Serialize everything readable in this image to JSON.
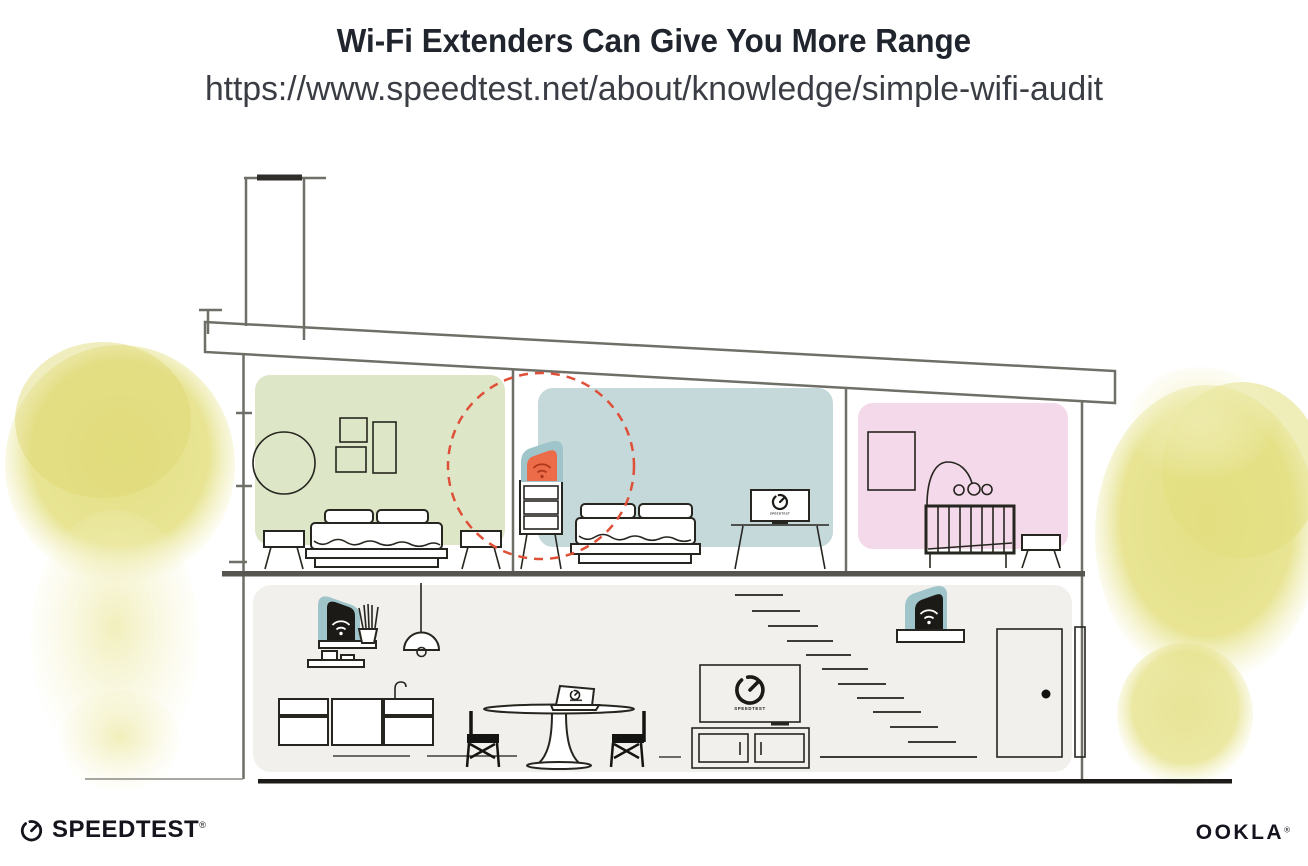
{
  "header": {
    "title": "Wi-Fi Extenders Can Give You More Range",
    "url": "https://www.speedtest.net/about/knowledge/simple-wifi-audit"
  },
  "illustration": {
    "tv_label": "SPEEDTEST",
    "bedroom_tv_label": "SPEEDTEST"
  },
  "footer": {
    "speedtest": "SPEEDTEST",
    "speedtest_reg": "®",
    "ookla": "OOKLA",
    "ookla_reg": "®"
  },
  "colors": {
    "title_text": "#20242d",
    "url_text": "#3a3e44",
    "architecture_line": "#6f6e67",
    "furniture_line": "#26251f",
    "floor_dark": "#1d1c19",
    "room_green": "#dde7c8",
    "room_blue": "#c5d9db",
    "room_pink": "#f3d9e9",
    "ground_floor": "#f1f0ed",
    "foliage_yellow": "#e5e187",
    "foliage_yellow_light": "#efecb0",
    "extender_teal": "#9fc5ca",
    "extender_orange": "#ec6b49",
    "wifi_red": "#b0391d",
    "router_black": "#1b1a17",
    "range_circle": "#df5038",
    "logo_dark": "#15141c"
  }
}
